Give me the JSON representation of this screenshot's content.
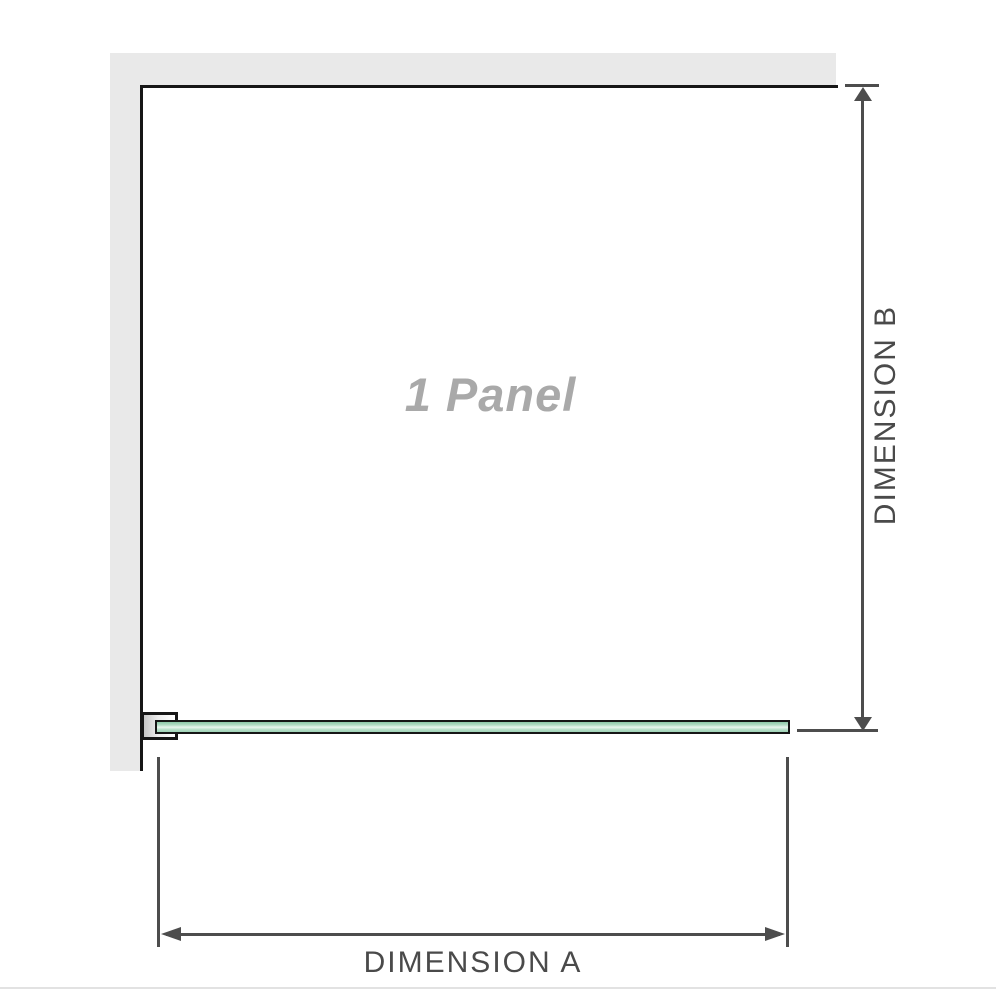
{
  "diagram": {
    "panel_label": "1 Panel",
    "dimension_a": {
      "label": "DIMENSION A"
    },
    "dimension_b": {
      "label": "DIMENSION B"
    }
  },
  "colors": {
    "wall": "#e9e9e9",
    "outline": "#161616",
    "dimension": "#4d4d4d",
    "labelText": "#4a4a4a",
    "panelText": "#a9a9a9",
    "glassTop": "#8cc9a8",
    "glassMid": "#b4dec6",
    "glassLight": "#e9f6ee",
    "glassBottom": "#9ed3b6",
    "divider": "#e2e2e2"
  }
}
